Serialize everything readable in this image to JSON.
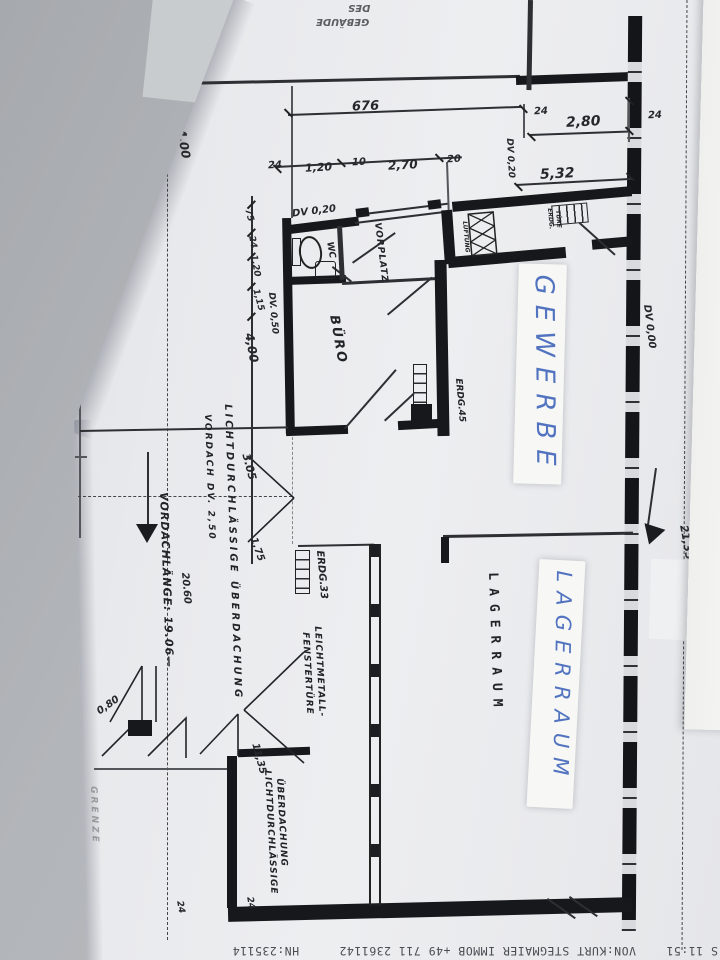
{
  "colors": {
    "ink_blue": "#5273c0",
    "paper": "#e8e9ec",
    "background_gray": "#b2b5b9",
    "plan_line": "#1b1c1f"
  },
  "plan": {
    "rooms": {
      "wc": "WC",
      "vorplatz": "VORPLATZ",
      "buero": "BÜRO",
      "lagerraum": "LAGERRAUM"
    },
    "tapes": {
      "gewerbe": "GEWERBE",
      "lagerraum": "LAGERRAUM"
    },
    "notes": {
      "vordachlaenge": "VORDACHLÄNGE: 19.06—",
      "ueberdachung1": "LICHTDURCHLÄSSIGE ÜBERDACHUNG",
      "vordach_dv": "VORDACH DV. 2,50",
      "erdg33": "ERDG.33",
      "erdg45": "ERDG.45",
      "leichtmetall1": "LEICHTMETALL-",
      "leichtmetall2": "FENSTERTÜRE",
      "ueberdachung2a": "LICHTDURCHLÄSSIGE",
      "ueberdachung2b": "ÜBERDACHUNG",
      "dv020_top": "DV 0,20",
      "dv020_wc": "DV 0,20",
      "dv050": "DV. 0,50",
      "dv000": "DV 0,00",
      "lueftung": "LÜFTUNG",
      "erdg_small": "ERDG.",
      "tuere_small": "TÜRE",
      "grenze": "GRENZE",
      "des": "DES",
      "gebaeude": "GEBÄUDE"
    },
    "dims": {
      "d676": "676",
      "d24a": "24",
      "d280": "2,80",
      "d24b": "24",
      "d24c": "24",
      "d120": "1,20",
      "d10": "10",
      "d270": "2,70",
      "d20": "20",
      "d532": "5,32",
      "d400a": "4,00",
      "d75": "75",
      "d24d": "24",
      "d120b": "1,20",
      "d115": "1,15",
      "d400b": "4,00",
      "d305": "3.05",
      "d175": "1,75",
      "d2060": "20.60",
      "d1135": "11,35",
      "d080": "0,80",
      "d2135": "21,35",
      "d24e": "24",
      "d24f": "24"
    }
  },
  "fax": {
    "time": "S 11:51",
    "line": "VON:KURT STEGMAIER IMMOB +49 711 2361142",
    "id": "HN:235114"
  }
}
